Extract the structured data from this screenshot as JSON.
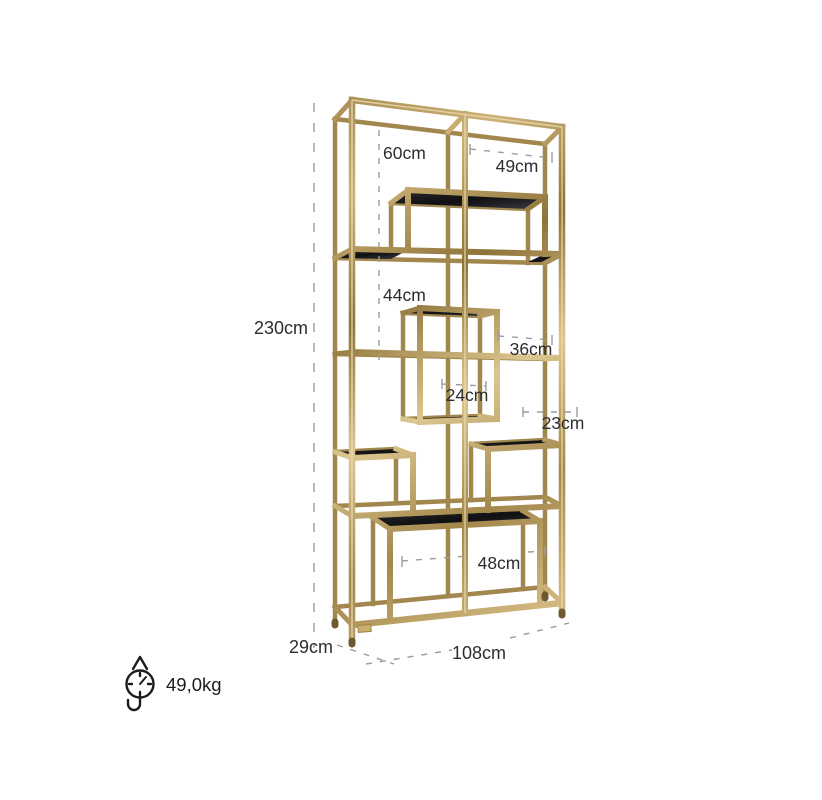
{
  "diagram": {
    "background_color": "#ffffff",
    "frame_gold_color": "#bfa065",
    "glass_color": "#1b1b1d",
    "dimension_line_color": "#9c9c9c",
    "text_color": "#2d2d2d",
    "labels": {
      "total_height": "230cm",
      "total_width": "108cm",
      "depth": "29cm",
      "top_section_height": "60cm",
      "top_right_opening_width": "49cm",
      "mid_section_height": "44cm",
      "mid_right_opening_width": "36cm",
      "center_box_width": "24cm",
      "right_shelf_section_height": "23cm",
      "bottom_shelf_width": "48cm"
    },
    "weight": {
      "value": "49,0kg",
      "icon": "hanging-scale-icon"
    }
  }
}
